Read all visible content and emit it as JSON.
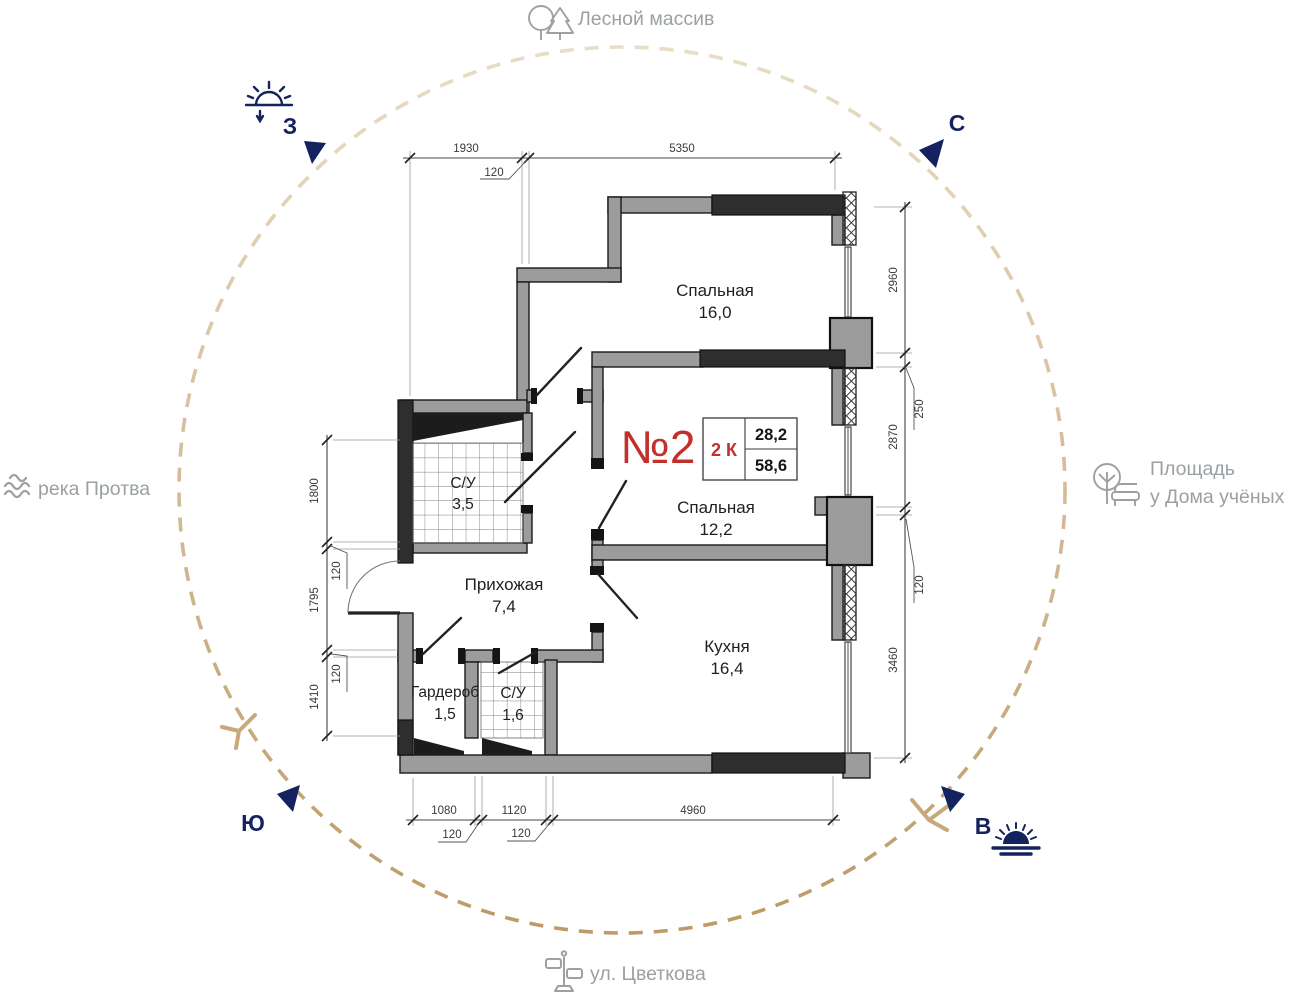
{
  "compass": {
    "north_label": "С",
    "east_label": "В",
    "south_label": "Ю",
    "west_label": "З"
  },
  "landmarks": {
    "top": "Лесной массив",
    "left": "река Протва",
    "right_line1": "Площадь",
    "right_line2": "у Дома учёных",
    "bottom": "ул. Цветкова"
  },
  "apartment": {
    "number": "№2",
    "type": "2 К",
    "living_area": "28,2",
    "total_area": "58,6"
  },
  "rooms": [
    {
      "name": "Спальная",
      "area": "16,0"
    },
    {
      "name": "Спальная",
      "area": "12,2"
    },
    {
      "name": "Кухня",
      "area": "16,4"
    },
    {
      "name": "Прихожая",
      "area": "7,4"
    },
    {
      "name": "С/У",
      "area": "3,5"
    },
    {
      "name": "Гардероб",
      "area": "1,5"
    },
    {
      "name": "С/У",
      "area": "1,6"
    }
  ],
  "dimensions": {
    "top": [
      "1930",
      "120",
      "5350"
    ],
    "right": [
      "2960",
      "250",
      "2870",
      "120",
      "3460"
    ],
    "left": [
      "1800",
      "120",
      "1795",
      "120",
      "1410"
    ],
    "bottom": [
      "1080",
      "120",
      "1120",
      "120",
      "4960"
    ]
  },
  "icons": {
    "top": "trees-icon",
    "left": "waves-icon",
    "right": "park-bench-icon",
    "bottom": "signpost-icon",
    "west": "sunset-icon",
    "east": "sunrise-icon"
  },
  "colors": {
    "accent_red": "#c2302c",
    "navy": "#14235f",
    "circle_tan": "#c9a87c",
    "landmark_gray": "#9aa0a3",
    "wall_gray": "#9c9c9c",
    "wall_dark": "#2e2e2e"
  }
}
